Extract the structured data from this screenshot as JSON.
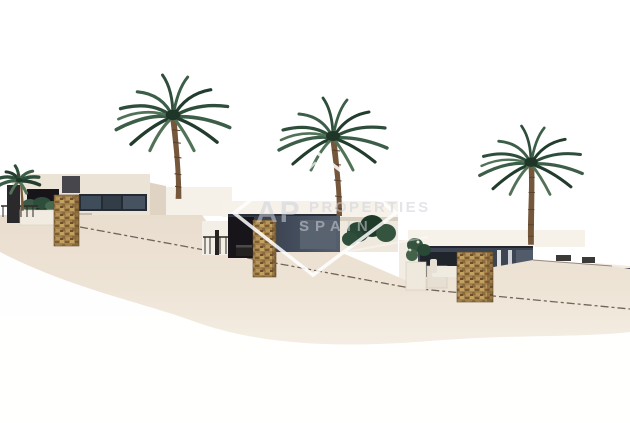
{
  "scene": {
    "title": "New build modern villas 3D render",
    "description": "Architectural rendering of three terraced modern villas with palm trees on a white background, watermarked",
    "background": "#ffffff"
  },
  "watermark": {
    "monogram": "AP",
    "word1": "PROPERTIES",
    "word2": "SPAIN",
    "text_color": "rgba(205,208,216,0.55)",
    "logo_color": "rgba(255,255,255,0.85)"
  },
  "palette": {
    "wall_cream": "#ece3d7",
    "wall_light": "#f5f0e8",
    "wall_side": "#dfd4c3",
    "fascia_white": "#f6f2ea",
    "ground_beige": "#e8dccd",
    "glass_dark": "#3d4452",
    "glass_pane": "#59636f",
    "opening_dark": "#18151a",
    "stone_tan": "#a3804a",
    "trunk_brown": "#75573c",
    "frond_green_1": "#2e4e3b",
    "frond_green_2": "#3c5e48",
    "frond_green_3": "#223d2e",
    "frond_green_4": "#517257",
    "bush_green": "#2a4836",
    "cap_line": "#5a4f43",
    "railing_dark": "#2c2a27",
    "chimney_gray": "#46464c"
  },
  "objects": {
    "villa_left": "villa-left",
    "villa_middle": "villa-middle",
    "villa_right": "villa-right",
    "palm_count": "4"
  }
}
